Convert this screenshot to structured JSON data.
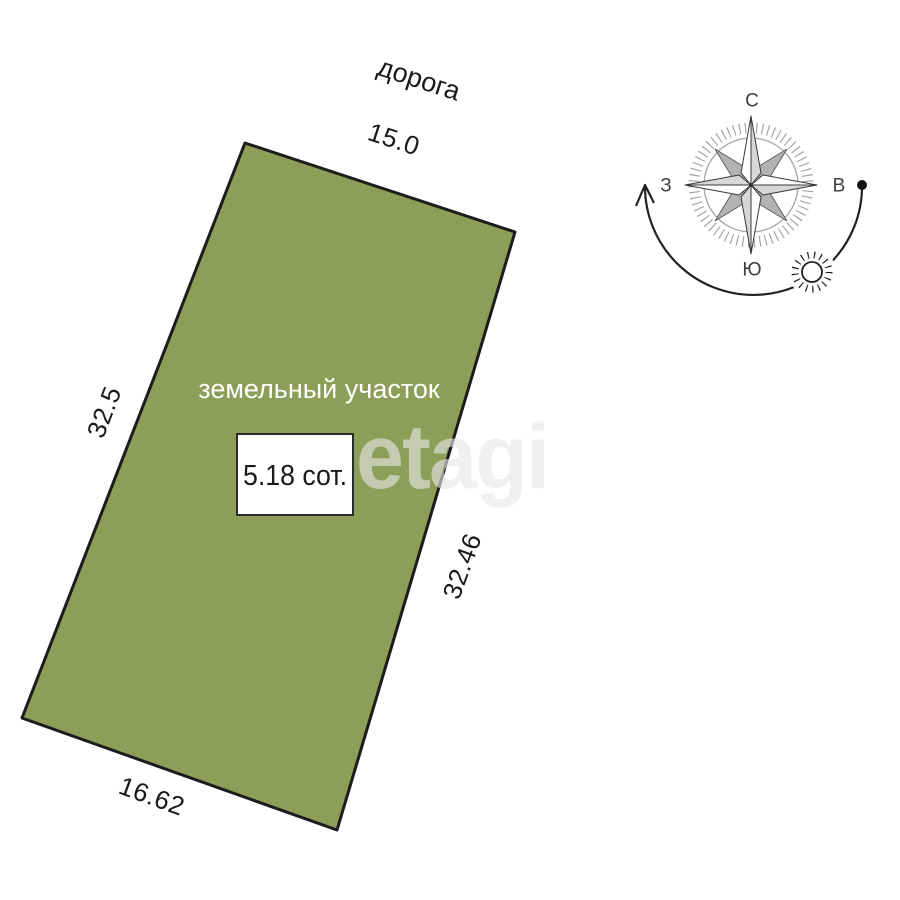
{
  "road": {
    "label": "дорога"
  },
  "parcel": {
    "label": "земельный участок",
    "area": "5.18 сот.",
    "dimensions": {
      "top": "15.0",
      "left": "32.5",
      "right": "32.46",
      "bottom": "16.62"
    },
    "fill": "#8e9d58",
    "stroke": "#1c1c1c"
  },
  "compass": {
    "north": "С",
    "east": "В",
    "south": "Ю",
    "west": "З"
  },
  "watermark": "etagi",
  "colors": {
    "background": "#ffffff",
    "text": "#1a1a1a",
    "parcel_text": "#ffffff",
    "compass_gray": "#b3b3b3",
    "tick_gray": "#8c8c8c"
  }
}
